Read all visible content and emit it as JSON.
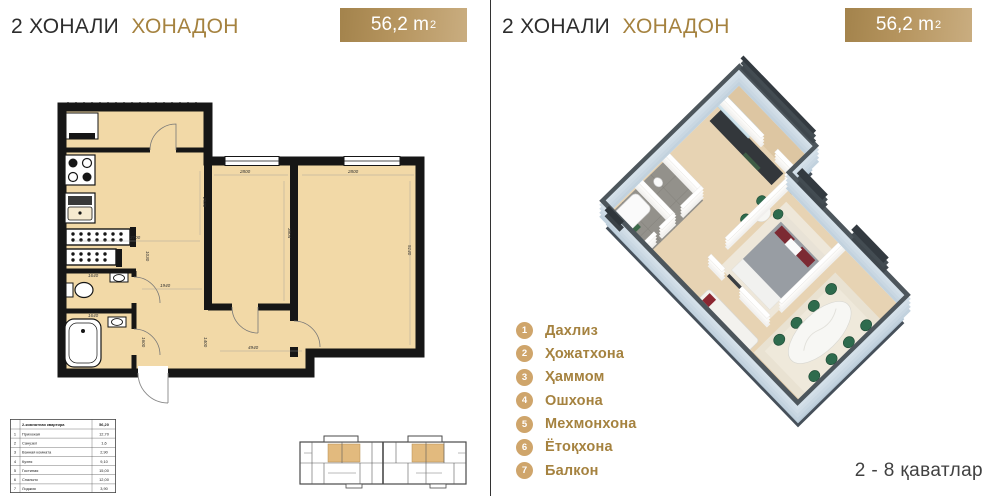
{
  "header": {
    "title_prefix": "2 ХОНАЛИ",
    "title_accent": "ХОНАДОН",
    "area_value": "56,2 m",
    "area_sup": "2"
  },
  "colors": {
    "gold_accent": "#a5823f",
    "badge_gradient_from": "#a3834c",
    "badge_gradient_to": "#c9ad80",
    "legend_circle": "#cfa56b",
    "plan_room_fill": "#f2d9a7",
    "plan_wall": "#161616",
    "highlight_unit": "#e2ba7e",
    "chair_green": "#2e6b4d",
    "slab_blue": "#c9d7e2"
  },
  "plan2d": {
    "dimensions": {
      "kitchen_w": "3700",
      "kitchen_h": "2530",
      "bedroom_w": "2800",
      "bedroom_h": "3804",
      "living_w": "2800",
      "living_h": "5140",
      "hall_w": "1940",
      "hall_h": "1030",
      "wc_w": "1640",
      "bath_w": "1640",
      "bath_h": "1600",
      "entry_h": "1400",
      "bottom_w": "4940"
    }
  },
  "area_table": {
    "header_label": "2-комнатная квартира",
    "header_value": "56,20",
    "rows": [
      {
        "num": "1",
        "name": "Прихожая",
        "value": "12,70"
      },
      {
        "num": "2",
        "name": "Санузел",
        "value": "1,6"
      },
      {
        "num": "3",
        "name": "Ванная комната",
        "value": "2,90"
      },
      {
        "num": "4",
        "name": "Кухня",
        "value": "9,10"
      },
      {
        "num": "5",
        "name": "Гостиная",
        "value": "15,00"
      },
      {
        "num": "6",
        "name": "Спальня",
        "value": "12,00"
      },
      {
        "num": "7",
        "name": "Лоджия",
        "value": "3,90"
      }
    ]
  },
  "legend": {
    "items": [
      {
        "num": "1",
        "label": "Дахлиз"
      },
      {
        "num": "2",
        "label": "Ҳожатхона"
      },
      {
        "num": "3",
        "label": "Ҳаммом"
      },
      {
        "num": "4",
        "label": "Ошхона"
      },
      {
        "num": "5",
        "label": "Мехмонхона"
      },
      {
        "num": "6",
        "label": "Ётоқхона"
      },
      {
        "num": "7",
        "label": "Балкон"
      }
    ]
  },
  "floors_note": "2 - 8  қаватлар"
}
